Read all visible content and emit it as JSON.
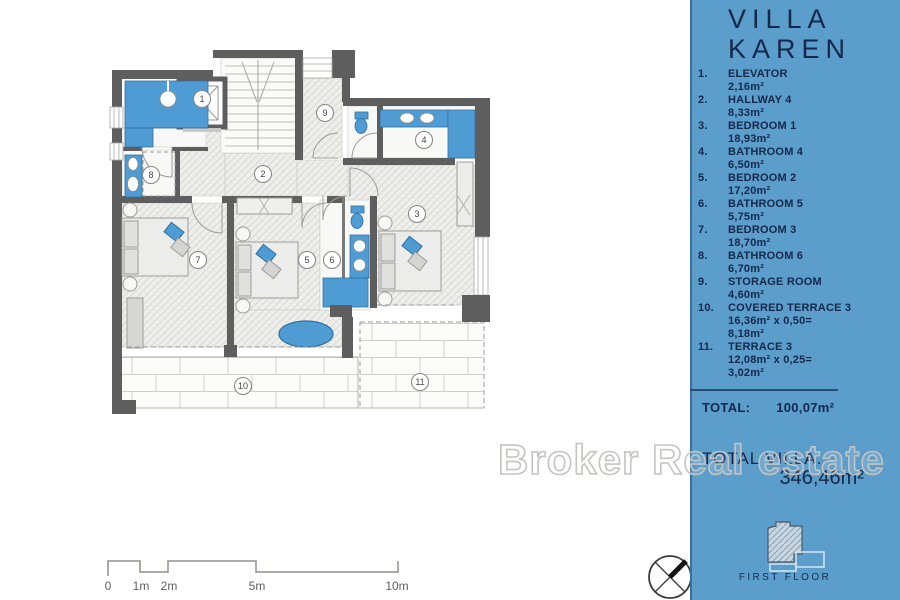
{
  "panel": {
    "title": [
      "VILLA",
      "KAREN"
    ],
    "items": [
      {
        "num": "1.",
        "name": "ELEVATOR",
        "areas": [
          "2,16m²"
        ]
      },
      {
        "num": "2.",
        "name": "HALLWAY 4",
        "areas": [
          "8,33m²"
        ]
      },
      {
        "num": "3.",
        "name": "BEDROOM 1",
        "areas": [
          "18,93m²"
        ]
      },
      {
        "num": "4.",
        "name": "BATHROOM 4",
        "areas": [
          "6,50m²"
        ]
      },
      {
        "num": "5.",
        "name": "BEDROOM 2",
        "areas": [
          "17,20m²"
        ]
      },
      {
        "num": "6.",
        "name": "BATHROOM 5",
        "areas": [
          "5,75m²"
        ]
      },
      {
        "num": "7.",
        "name": "BEDROOM 3",
        "areas": [
          "18,70m²"
        ]
      },
      {
        "num": "8.",
        "name": "BATHROOM 6",
        "areas": [
          "6,70m²"
        ]
      },
      {
        "num": "9.",
        "name": "STORAGE ROOM",
        "areas": [
          "4,60m²"
        ]
      },
      {
        "num": "10.",
        "name": "COVERED TERRACE 3",
        "areas": [
          "16,36m² x 0,50=",
          "8,18m²"
        ]
      },
      {
        "num": "11.",
        "name": "TERRACE 3",
        "areas": [
          "12,08m² x 0,25=",
          "3,02m²"
        ]
      }
    ],
    "total_label": "TOTAL:",
    "total_value": "100,07m²",
    "total_villa_label": "TOTAL VILLA:",
    "total_villa_value": "346,46m²",
    "floor_label": "FIRST FLOOR"
  },
  "watermark": "Broker Real estate",
  "plan": {
    "rooms": [
      "1",
      "2",
      "3",
      "4",
      "5",
      "6",
      "7",
      "8",
      "9",
      "10",
      "11"
    ]
  },
  "scale": {
    "labels": [
      "0",
      "1m",
      "2m",
      "5m",
      "10m"
    ]
  },
  "colors": {
    "panel_blue": "#5B9DCB",
    "fixture_blue": "#4F9CD4",
    "navy_text": "#16284A",
    "wall_gray": "#5E5E5E"
  }
}
